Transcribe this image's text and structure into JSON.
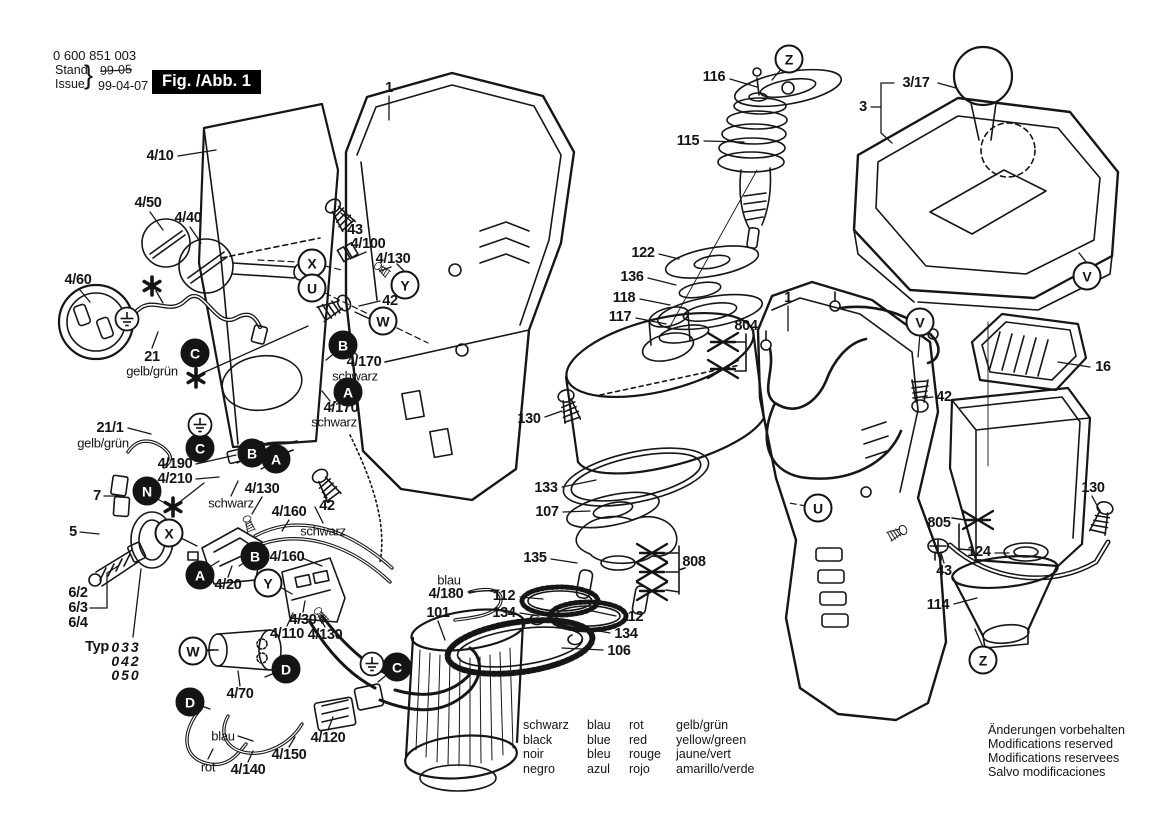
{
  "header": {
    "part_number": "0 600 851 003",
    "stand_label": "Stand",
    "issue_label": "Issue",
    "brace": "}",
    "superseded_date": "99-05",
    "issue_date": "99-04-07",
    "figure_label": "Fig. /Abb. 1"
  },
  "legend": {
    "columns": [
      [
        "schwarz",
        "black",
        "noir",
        "negro"
      ],
      [
        "blau",
        "blue",
        "bleu",
        "azul"
      ],
      [
        "rot",
        "red",
        "rouge",
        "rojo"
      ],
      [
        "gelb/grün",
        "yellow/green",
        "jaune/vert",
        "amarillo/verde"
      ]
    ]
  },
  "footer_notes": [
    "Änderungen vorbehalten",
    "Modifications reserved",
    "Modifications reservees",
    "Salvo modificaciones"
  ],
  "colors": {
    "ink": "#141414",
    "paper": "#ffffff"
  },
  "part_labels": [
    {
      "text": "1",
      "x": 389,
      "y": 88
    },
    {
      "text": "4/10",
      "x": 160,
      "y": 156
    },
    {
      "text": "4/50",
      "x": 148,
      "y": 203
    },
    {
      "text": "4/40",
      "x": 188,
      "y": 218
    },
    {
      "text": "43",
      "x": 355,
      "y": 230
    },
    {
      "text": "4/100",
      "x": 368,
      "y": 244
    },
    {
      "text": "4/130",
      "x": 393,
      "y": 259
    },
    {
      "text": "42",
      "x": 390,
      "y": 301
    },
    {
      "text": "4/60",
      "x": 78,
      "y": 280
    },
    {
      "text": "21",
      "x": 152,
      "y": 357
    },
    {
      "text": "gelb/grün",
      "x": 152,
      "y": 371,
      "style": "p"
    },
    {
      "text": "4/170",
      "x": 364,
      "y": 362
    },
    {
      "text": "schwarz",
      "x": 355,
      "y": 376,
      "style": "p"
    },
    {
      "text": "4/170",
      "x": 341,
      "y": 408
    },
    {
      "text": "schwarz",
      "x": 334,
      "y": 422,
      "style": "p"
    },
    {
      "text": "21/1",
      "x": 110,
      "y": 428
    },
    {
      "text": "gelb/grün",
      "x": 103,
      "y": 443,
      "style": "p"
    },
    {
      "text": "4/190",
      "x": 175,
      "y": 464
    },
    {
      "text": "4/210",
      "x": 175,
      "y": 479
    },
    {
      "text": "7",
      "x": 97,
      "y": 496
    },
    {
      "text": "schwarz",
      "x": 231,
      "y": 503,
      "style": "p"
    },
    {
      "text": "4/130",
      "x": 262,
      "y": 489
    },
    {
      "text": "4/160",
      "x": 289,
      "y": 512
    },
    {
      "text": "5",
      "x": 73,
      "y": 532
    },
    {
      "text": "42",
      "x": 327,
      "y": 506
    },
    {
      "text": "schwarz",
      "x": 323,
      "y": 531,
      "style": "p"
    },
    {
      "text": "4/160",
      "x": 287,
      "y": 557
    },
    {
      "text": "4/20",
      "x": 228,
      "y": 585
    },
    {
      "text": "6/2",
      "x": 78,
      "y": 593
    },
    {
      "text": "6/3",
      "x": 78,
      "y": 608
    },
    {
      "text": "6/4",
      "x": 78,
      "y": 623
    },
    {
      "text": "Typ",
      "x": 97,
      "y": 647
    },
    {
      "text": "033",
      "x": 126,
      "y": 647,
      "style": "i"
    },
    {
      "text": "042",
      "x": 126,
      "y": 661,
      "style": "i"
    },
    {
      "text": "050",
      "x": 126,
      "y": 675,
      "style": "i"
    },
    {
      "text": "blau",
      "x": 449,
      "y": 580,
      "style": "p"
    },
    {
      "text": "4/180",
      "x": 446,
      "y": 594
    },
    {
      "text": "101",
      "x": 438,
      "y": 613
    },
    {
      "text": "4/30",
      "x": 303,
      "y": 620
    },
    {
      "text": "4/110",
      "x": 287,
      "y": 634
    },
    {
      "text": "4/130",
      "x": 325,
      "y": 635
    },
    {
      "text": "4/70",
      "x": 240,
      "y": 694
    },
    {
      "text": "4/120",
      "x": 328,
      "y": 738
    },
    {
      "text": "blau",
      "x": 223,
      "y": 736,
      "style": "p"
    },
    {
      "text": "4/150",
      "x": 289,
      "y": 755
    },
    {
      "text": "rot",
      "x": 208,
      "y": 767,
      "style": "p"
    },
    {
      "text": "4/140",
      "x": 248,
      "y": 770
    },
    {
      "text": "130",
      "x": 529,
      "y": 419
    },
    {
      "text": "133",
      "x": 546,
      "y": 488
    },
    {
      "text": "107",
      "x": 547,
      "y": 512
    },
    {
      "text": "135",
      "x": 535,
      "y": 558
    },
    {
      "text": "112",
      "x": 504,
      "y": 596
    },
    {
      "text": "134",
      "x": 504,
      "y": 613
    },
    {
      "text": "112",
      "x": 632,
      "y": 617
    },
    {
      "text": "134",
      "x": 626,
      "y": 634
    },
    {
      "text": "106",
      "x": 619,
      "y": 651
    },
    {
      "text": "808",
      "x": 694,
      "y": 562
    },
    {
      "text": "116",
      "x": 714,
      "y": 77
    },
    {
      "text": "115",
      "x": 688,
      "y": 141
    },
    {
      "text": "122",
      "x": 643,
      "y": 253
    },
    {
      "text": "136",
      "x": 632,
      "y": 277
    },
    {
      "text": "118",
      "x": 624,
      "y": 298
    },
    {
      "text": "117",
      "x": 620,
      "y": 317
    },
    {
      "text": "804",
      "x": 746,
      "y": 326
    },
    {
      "text": "1",
      "x": 788,
      "y": 298
    },
    {
      "text": "3/17",
      "x": 916,
      "y": 83
    },
    {
      "text": "3",
      "x": 863,
      "y": 107
    },
    {
      "text": "16",
      "x": 1103,
      "y": 367
    },
    {
      "text": "42",
      "x": 944,
      "y": 397
    },
    {
      "text": "130",
      "x": 1093,
      "y": 488
    },
    {
      "text": "805",
      "x": 939,
      "y": 523
    },
    {
      "text": "124",
      "x": 979,
      "y": 552
    },
    {
      "text": "43",
      "x": 944,
      "y": 571
    },
    {
      "text": "114",
      "x": 938,
      "y": 605
    }
  ],
  "callout_circles": [
    {
      "letter": "Z",
      "x": 789,
      "y": 59,
      "filled": false
    },
    {
      "letter": "X",
      "x": 312,
      "y": 263,
      "filled": false
    },
    {
      "letter": "U",
      "x": 312,
      "y": 288,
      "filled": false
    },
    {
      "letter": "Y",
      "x": 405,
      "y": 285,
      "filled": false
    },
    {
      "letter": "W",
      "x": 383,
      "y": 321,
      "filled": false
    },
    {
      "letter": "V",
      "x": 1087,
      "y": 276,
      "filled": false
    },
    {
      "letter": "V",
      "x": 920,
      "y": 322,
      "filled": false
    },
    {
      "letter": "U",
      "x": 818,
      "y": 508,
      "filled": false
    },
    {
      "letter": "X",
      "x": 169,
      "y": 533,
      "filled": false
    },
    {
      "letter": "Y",
      "x": 268,
      "y": 583,
      "filled": false
    },
    {
      "letter": "W",
      "x": 193,
      "y": 651,
      "filled": false
    },
    {
      "letter": "Z",
      "x": 983,
      "y": 660,
      "filled": false
    },
    {
      "letter": "C",
      "x": 195,
      "y": 353,
      "filled": true
    },
    {
      "letter": "B",
      "x": 343,
      "y": 345,
      "filled": true
    },
    {
      "letter": "A",
      "x": 348,
      "y": 392,
      "filled": true
    },
    {
      "letter": "C",
      "x": 200,
      "y": 448,
      "filled": true
    },
    {
      "letter": "B",
      "x": 252,
      "y": 453,
      "filled": true
    },
    {
      "letter": "A",
      "x": 276,
      "y": 459,
      "filled": true
    },
    {
      "letter": "N",
      "x": 147,
      "y": 491,
      "filled": true
    },
    {
      "letter": "B",
      "x": 255,
      "y": 556,
      "filled": true
    },
    {
      "letter": "A",
      "x": 200,
      "y": 575,
      "filled": true
    },
    {
      "letter": "D",
      "x": 286,
      "y": 669,
      "filled": true
    },
    {
      "letter": "D",
      "x": 190,
      "y": 702,
      "filled": true
    },
    {
      "letter": "C",
      "x": 397,
      "y": 667,
      "filled": true
    }
  ],
  "symbols": {
    "asterisks": [
      {
        "x": 152,
        "y": 286
      },
      {
        "x": 196,
        "y": 378
      },
      {
        "x": 173,
        "y": 507
      }
    ],
    "ground_icons": [
      {
        "x": 127,
        "y": 319
      },
      {
        "x": 200,
        "y": 425
      },
      {
        "x": 372,
        "y": 664
      }
    ],
    "deleted_parts": [
      {
        "x": 723,
        "y": 342
      },
      {
        "x": 723,
        "y": 369
      },
      {
        "x": 652,
        "y": 553
      },
      {
        "x": 652,
        "y": 572
      },
      {
        "x": 652,
        "y": 591
      },
      {
        "x": 978,
        "y": 520
      }
    ]
  }
}
